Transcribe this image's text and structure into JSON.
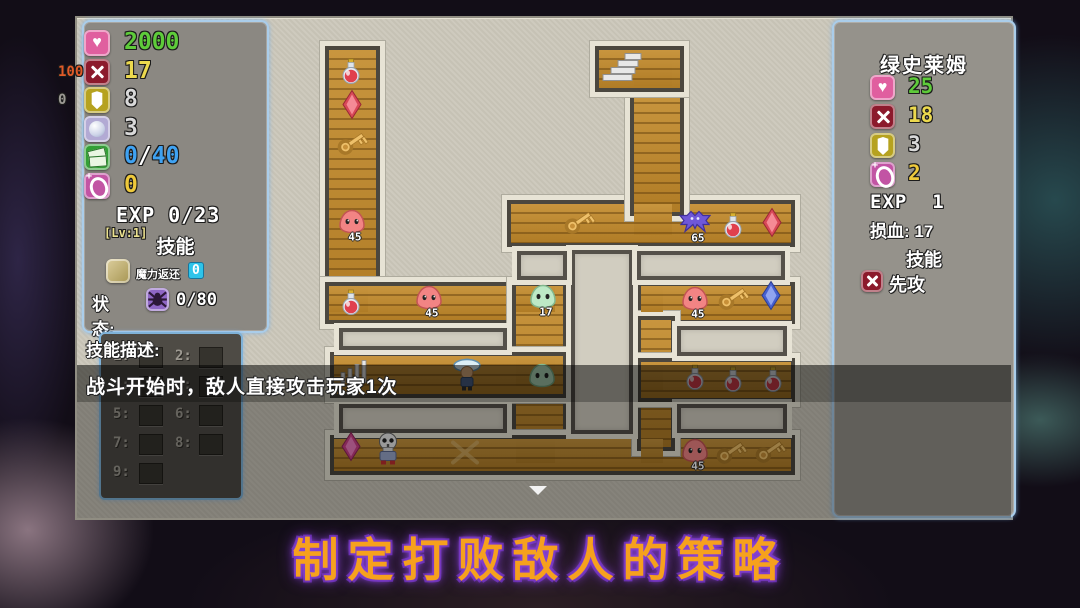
{
  "banner": {
    "text": "制定打败敌人的策略"
  },
  "left_panel": {
    "stats": [
      {
        "icon": "heart-icon",
        "prefix": "",
        "value": "2000",
        "color": "#5ecb3a",
        "prefix_color": ""
      },
      {
        "icon": "attack-icon",
        "prefix": "100",
        "value": "17",
        "color": "#ecd94e",
        "prefix_color": "#e05a28"
      },
      {
        "icon": "shield-icon",
        "prefix": "0",
        "value": "8",
        "color": "#d9d9d9",
        "prefix_color": "#9b9993"
      },
      {
        "icon": "orb-icon",
        "prefix": "",
        "value": "3",
        "color": "#d9d9d9",
        "prefix_color": ""
      },
      {
        "icon": "money-icon",
        "prefix": "",
        "value": "0/40",
        "color": "#3fa2f2",
        "prefix_color": ""
      },
      {
        "icon": "coin-icon",
        "prefix": "",
        "value": "0",
        "color": "#eec93b",
        "prefix_color": ""
      }
    ],
    "exp_label": "EXP 0/23",
    "level_label": "[Lv:1]",
    "skills_header": "技能",
    "skill": {
      "name": "魔力返还",
      "count": "0"
    },
    "status_label": "状态:",
    "status_value": "0/80"
  },
  "skill_panel": {
    "title": "技能描述:",
    "slot_labels": [
      "1:",
      "2:",
      "3:",
      "4:",
      "5:",
      "6:",
      "7:",
      "8:",
      "9:"
    ],
    "description": "战斗开始时，敌人直接攻击玩家1次"
  },
  "enemy_panel": {
    "name": "绿史莱姆",
    "stats": [
      {
        "icon": "heart-icon",
        "value": "25",
        "color": "#5ecb3a"
      },
      {
        "icon": "attack-icon",
        "value": "18",
        "color": "#ecd94e"
      },
      {
        "icon": "shield-icon",
        "value": "3",
        "color": "#d9d9d9"
      },
      {
        "icon": "coin-icon",
        "value": "2",
        "color": "#eec93b"
      }
    ],
    "exp_label": "EXP  1",
    "damage_label": "损血: 17",
    "skills_header": "技能",
    "skill_name": "先攻"
  },
  "map": {
    "entities": [
      {
        "type": "potion",
        "x": 274,
        "y": 56,
        "label": ""
      },
      {
        "type": "gem-red",
        "x": 275,
        "y": 89,
        "label": ""
      },
      {
        "type": "key",
        "x": 275,
        "y": 127,
        "label": ""
      },
      {
        "type": "slime-red",
        "x": 275,
        "y": 206,
        "label": "45"
      },
      {
        "type": "potion",
        "x": 274,
        "y": 287,
        "label": ""
      },
      {
        "type": "slime-red",
        "x": 352,
        "y": 282,
        "label": "45"
      },
      {
        "type": "slime-green",
        "x": 466,
        "y": 281,
        "label": "17"
      },
      {
        "type": "bars",
        "x": 277,
        "y": 355,
        "label": ""
      },
      {
        "type": "player",
        "x": 390,
        "y": 358,
        "label": ""
      },
      {
        "type": "slime-green",
        "x": 465,
        "y": 360,
        "label": ""
      },
      {
        "type": "key",
        "x": 502,
        "y": 206,
        "label": ""
      },
      {
        "type": "bat",
        "x": 618,
        "y": 207,
        "label": "65"
      },
      {
        "type": "potion",
        "x": 656,
        "y": 210,
        "label": ""
      },
      {
        "type": "gem-red",
        "x": 695,
        "y": 207,
        "label": ""
      },
      {
        "type": "stairs",
        "x": 545,
        "y": 54,
        "label": ""
      },
      {
        "type": "slime-red",
        "x": 618,
        "y": 283,
        "label": "45"
      },
      {
        "type": "key",
        "x": 656,
        "y": 282,
        "label": ""
      },
      {
        "type": "gem-blue",
        "x": 694,
        "y": 280,
        "label": ""
      },
      {
        "type": "potion",
        "x": 618,
        "y": 362,
        "label": ""
      },
      {
        "type": "potion",
        "x": 656,
        "y": 364,
        "label": ""
      },
      {
        "type": "potion",
        "x": 696,
        "y": 364,
        "label": ""
      },
      {
        "type": "gem-pink",
        "x": 274,
        "y": 431,
        "label": ""
      },
      {
        "type": "skeleton",
        "x": 311,
        "y": 433,
        "label": ""
      },
      {
        "type": "xmark",
        "x": 388,
        "y": 437,
        "label": ""
      },
      {
        "type": "slime-red",
        "x": 618,
        "y": 435,
        "label": "45"
      },
      {
        "type": "key",
        "x": 654,
        "y": 436,
        "label": ""
      },
      {
        "type": "key",
        "x": 693,
        "y": 435,
        "label": ""
      }
    ]
  }
}
